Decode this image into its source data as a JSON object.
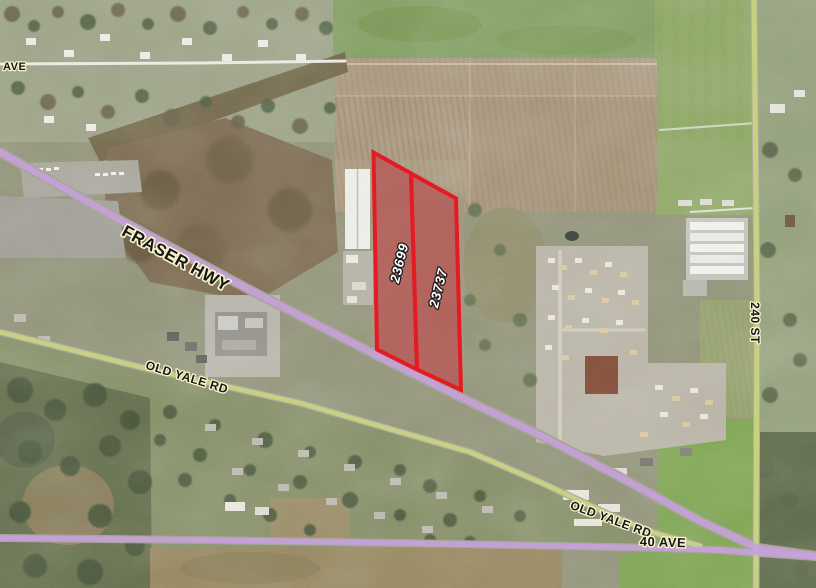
{
  "map": {
    "parcel_labels": {
      "left": "23699",
      "right": "23737"
    },
    "road_labels": {
      "ave": "AVE",
      "fraser_hwy": "FRASER HWY",
      "old_yale_rd_west": "OLD YALE RD",
      "old_yale_rd_east": "OLD YALE RD",
      "forty_ave": "40 AVE",
      "two_forty_st": "240 ST"
    },
    "colors": {
      "highway_highlight": "#c6a1dd",
      "road_highlight": "#c9d67e",
      "parcel_outline": "#e41b23",
      "parcel_fill": "#c42736",
      "label_halo": "#f7f3cd"
    }
  }
}
